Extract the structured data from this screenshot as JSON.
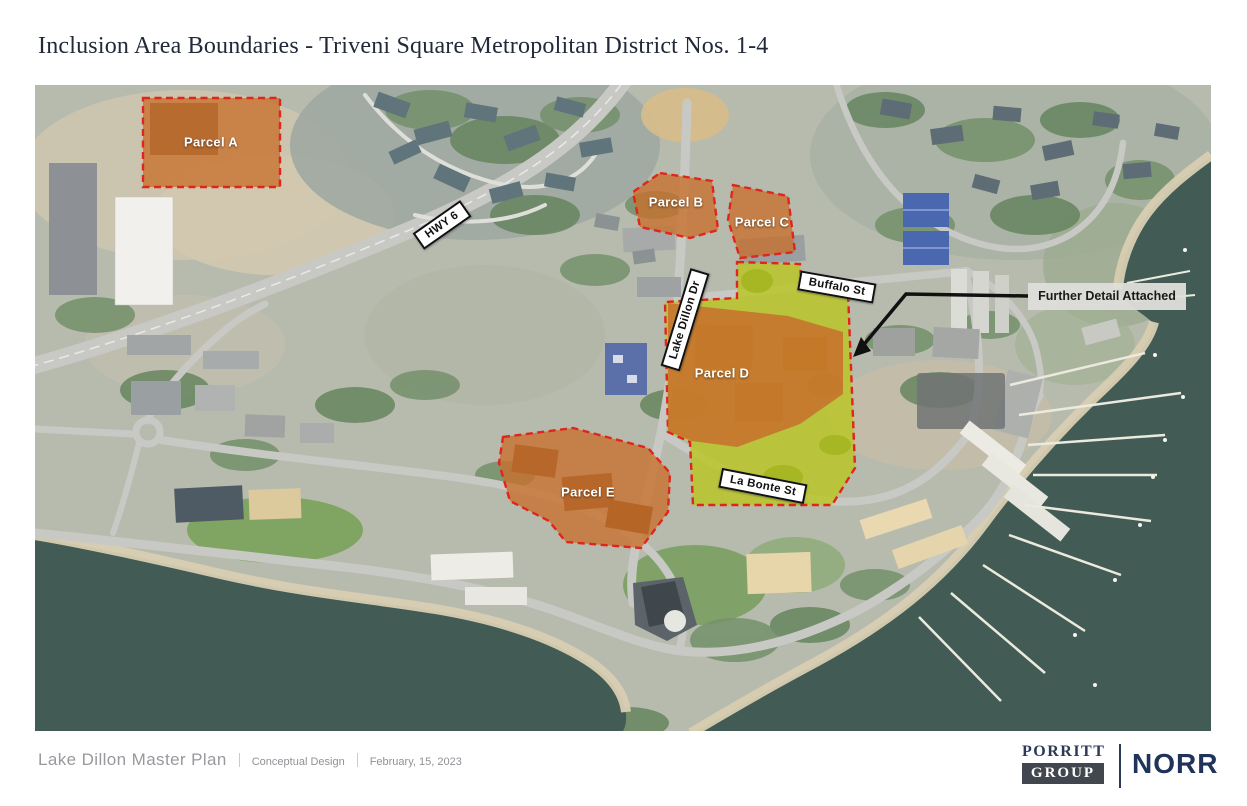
{
  "title": "Inclusion Area Boundaries - Triveni Square Metropolitan District Nos. 1-4",
  "map": {
    "parcels": [
      {
        "id": "parcel-a",
        "label": "Parcel A"
      },
      {
        "id": "parcel-b",
        "label": "Parcel B"
      },
      {
        "id": "parcel-c",
        "label": "Parcel C"
      },
      {
        "id": "parcel-d",
        "label": "Parcel D"
      },
      {
        "id": "parcel-e",
        "label": "Parcel E"
      }
    ],
    "road_labels": [
      {
        "id": "hwy-6",
        "label": "HWY 6"
      },
      {
        "id": "lake-dillon-dr",
        "label": "Lake Dillon Dr"
      },
      {
        "id": "buffalo-st",
        "label": "Buffalo St"
      },
      {
        "id": "la-bonte-st",
        "label": "La Bonte St"
      }
    ],
    "annotation": {
      "label": "Further Detail Attached"
    },
    "colors": {
      "parcel_fill": "#c8702c",
      "parcel_border": "#e0251c",
      "highlight_fill": "#b9c51f",
      "water": "#425c55",
      "annotation_bg": "#dfdfdb"
    }
  },
  "footer": {
    "project": "Lake Dillon Master Plan",
    "phase": "Conceptual Design",
    "date": "February, 15, 2023",
    "logos": {
      "porritt_top": "PORRITT",
      "porritt_bottom": "GROUP",
      "norr": "NORR"
    }
  }
}
